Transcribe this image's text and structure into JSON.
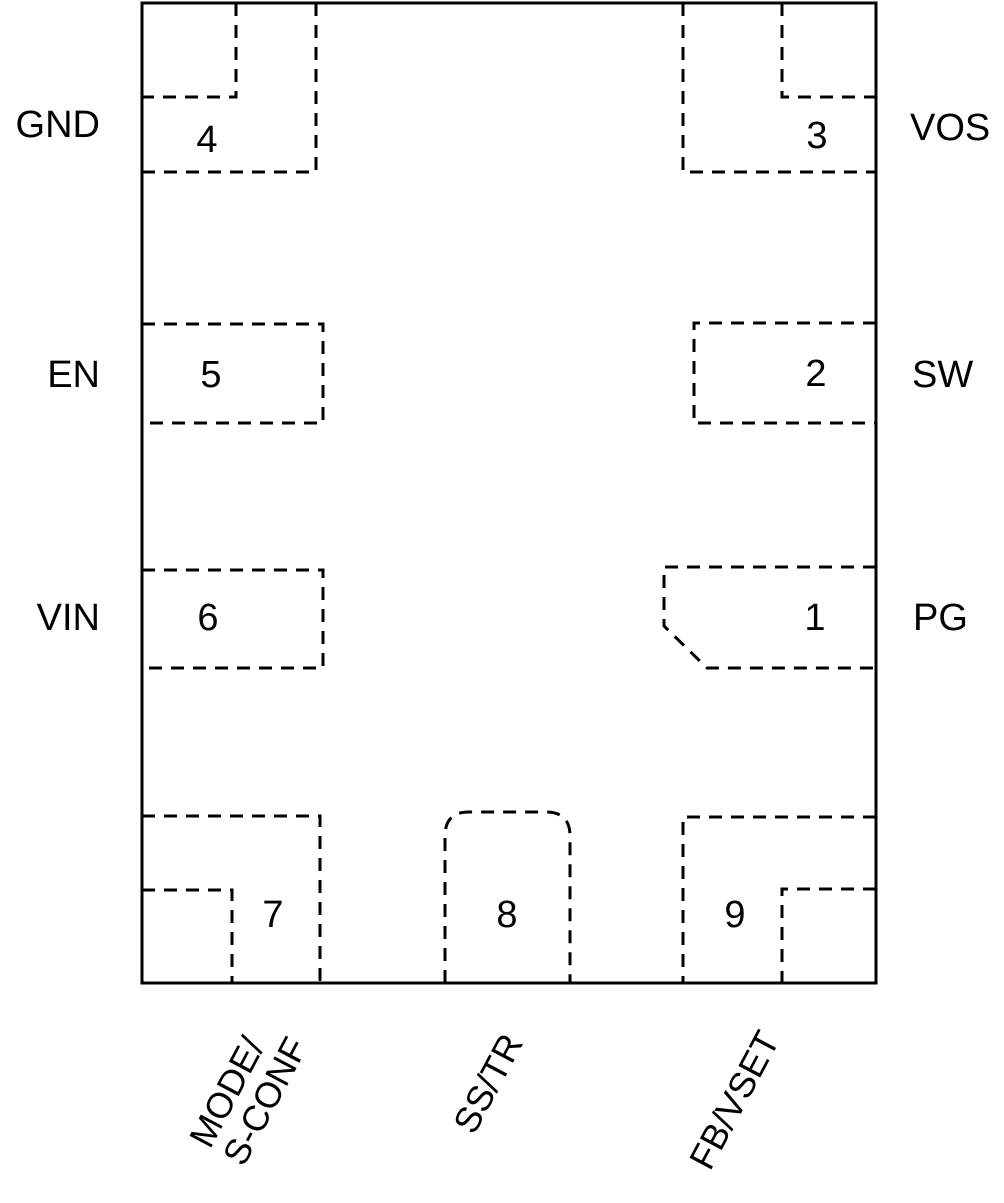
{
  "figure": {
    "type": "ic-package-pinout-diagram",
    "background_color": "#ffffff",
    "line_color": "#000000"
  },
  "pins": {
    "p1": {
      "number": "1",
      "name": "PG",
      "side": "right"
    },
    "p2": {
      "number": "2",
      "name": "SW",
      "side": "right"
    },
    "p3": {
      "number": "3",
      "name": "VOS",
      "side": "right"
    },
    "p4": {
      "number": "4",
      "name": "GND",
      "side": "left"
    },
    "p5": {
      "number": "5",
      "name": "EN",
      "side": "left"
    },
    "p6": {
      "number": "6",
      "name": "VIN",
      "side": "left"
    },
    "p7": {
      "number": "7",
      "name_line1": "MODE/",
      "name_line2": "S-CONF",
      "side": "bottom"
    },
    "p8": {
      "number": "8",
      "name": "SS/TR",
      "side": "bottom"
    },
    "p9": {
      "number": "9",
      "name": "FB/VSET",
      "side": "bottom"
    }
  }
}
